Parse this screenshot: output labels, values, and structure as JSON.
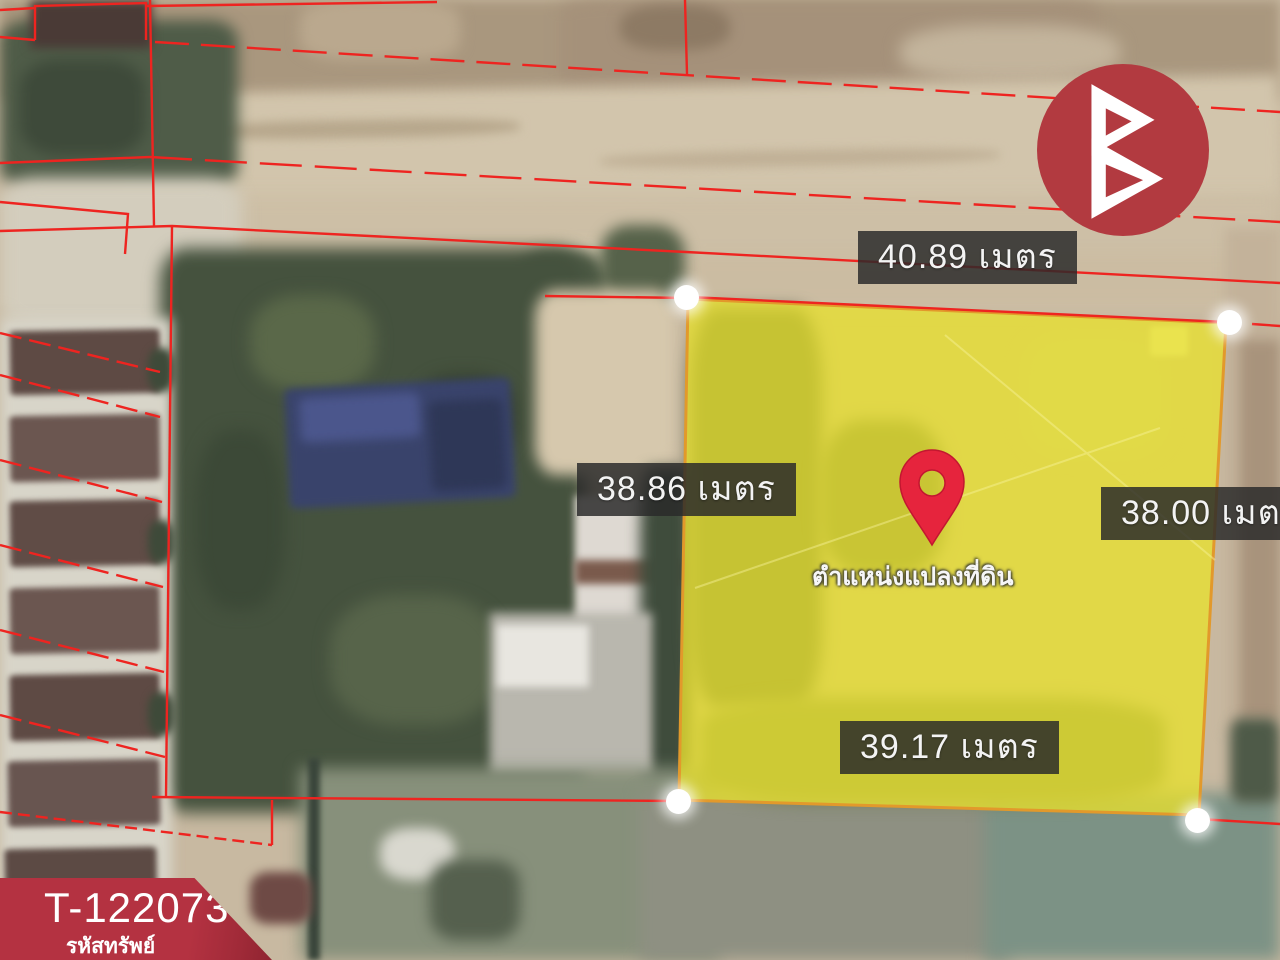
{
  "map": {
    "dimension_labels": {
      "top": "40.89 เมตร",
      "left": "38.86 เมตร",
      "right": "38.00 เมตร",
      "bottom": "39.17 เมตร"
    },
    "pin_caption": "ตำแหน่งแปลงที่ดิน",
    "colors": {
      "plot_fill": "#e8e02e",
      "plot_border": "#e2992b",
      "cadastral_line": "#ee2420",
      "pin": "#e6243d",
      "label_bg": "#2a2a2a"
    }
  },
  "badge": {
    "code": "T-122073",
    "label": "รหัสทรัพย์",
    "color": "#b43241"
  },
  "logo": {
    "icon": "brand-b-triangles-icon",
    "circle_color": "#b23a40"
  }
}
